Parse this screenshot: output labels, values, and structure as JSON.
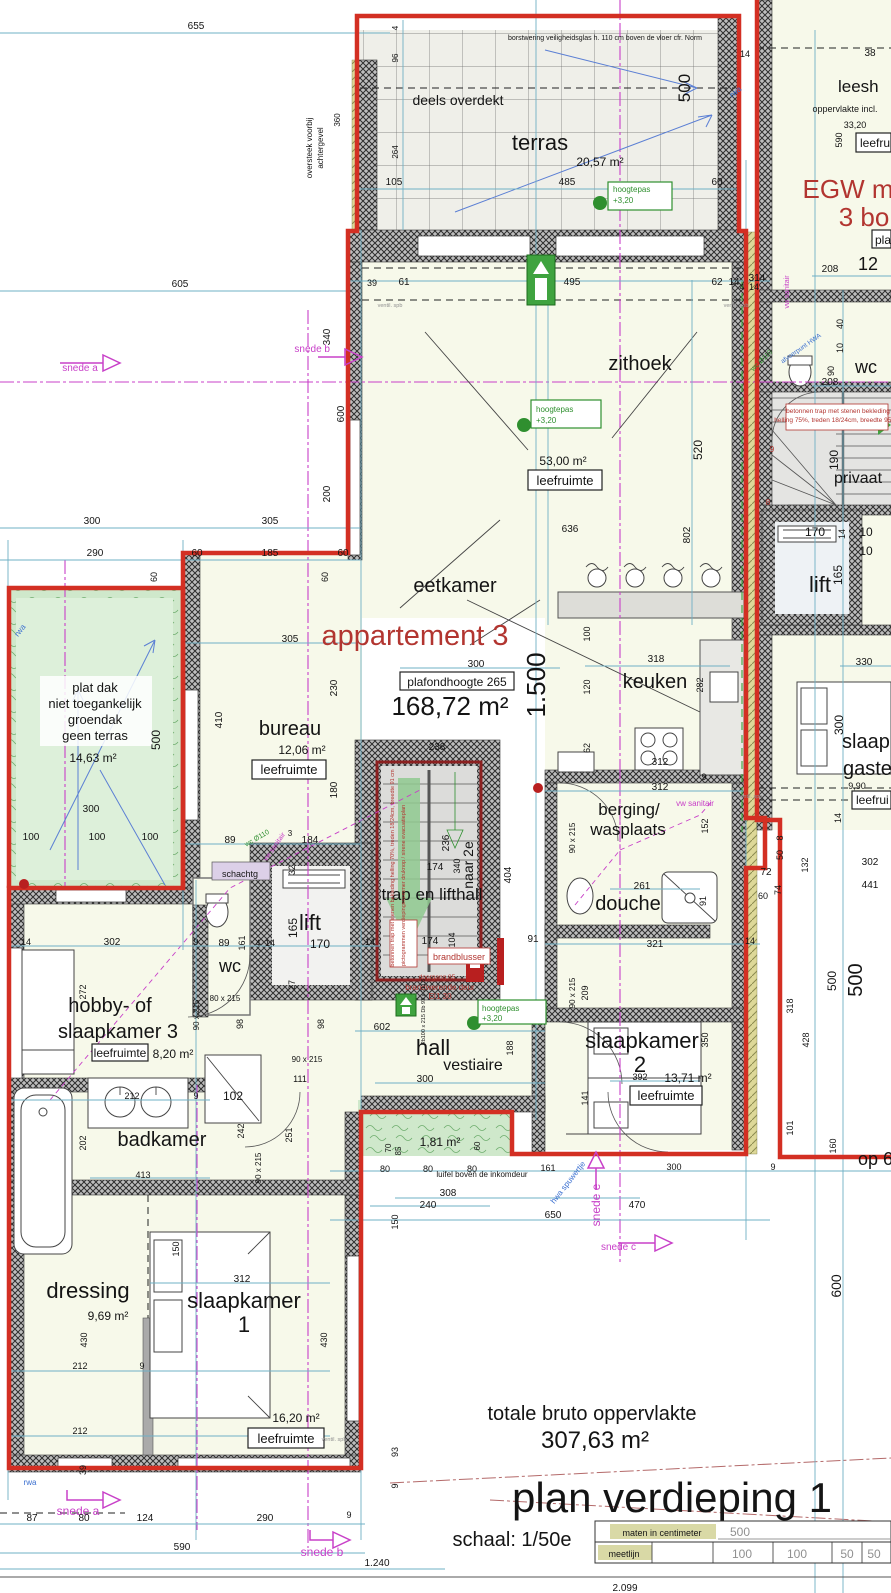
{
  "r": {
    "terras": "terras",
    "terras_a": "20,57 m²",
    "deels": "deels overdekt",
    "zithoek": "zithoek",
    "zithoek_a": "53,00 m²",
    "eetkamer": "eetkamer",
    "keuken": "keuken",
    "bureau": "bureau",
    "bureau_a": "12,06 m²",
    "traphall": "trap en lifthall",
    "naar2e": "naar 2e",
    "berging1": "berging/",
    "berging2": "wasplaats",
    "douche": "douche",
    "sk2": "slaapkamer",
    "sk2n": "2",
    "sk2_a": "13,71 m²",
    "hobby1": "hobby- of",
    "hobby2": "slaapkamer 3",
    "hobby_a": "8,20 m²",
    "badkamer": "badkamer",
    "wc": "wc",
    "lift": "lift",
    "hall": "hall",
    "vestiaire": "vestiaire",
    "dressing": "dressing",
    "dressing_a": "9,69 m²",
    "sk1": "slaapkamer",
    "sk1n": "1",
    "sk1_a": "16,20 m²",
    "privaat": "privaat",
    "schacht": "schachtg",
    "leeshoek": "leesh",
    "opp1": "oppervlakte incl.",
    "opp2": "33,20",
    "leefru": "leefru",
    "gast1": "slaapka",
    "gast2": "gaste",
    "gast_a": "9,90",
    "leefrui": "leefrui",
    "niche_a": "1,81 m²",
    "leef": "leefruimte"
  },
  "n": {
    "borst": "borstwering veiligheidsglas h. 110 cm boven de vloer cfr. Norm",
    "oversteek1": "oversteek voorbij",
    "oversteek2": "achtergevel",
    "pd1": "plat dak",
    "pd2": "niet toegankelijk",
    "pd3": "groendak",
    "pd4": "geen terras",
    "pd_a": "14,63 m²",
    "app": "appartement 3",
    "app_a": "168,72 m²",
    "plafond": "plafondhoogte 265",
    "level": "1.500",
    "hp": "hoogtepas",
    "hp_v": "+3,20",
    "egw1": "EGW m",
    "egw2": "3 bo",
    "egw3": "pla",
    "egw4": "12",
    "luifel": "luifel boven de inkomdeur",
    "trap1": "betonnen trap met stenen bekleding",
    "trap2": "helling 75%, treden 18/24cm, breedte 95 cm",
    "trapc": "betonnen trap met stenen bekleding  helling 70%, treden 18/24cm, breedte 91 cm",
    "picto": "pictogrammen verdiepingsnummer druknop / sirene evacuatieplan",
    "blus": "brandblusser",
    "deur1": "brandwerende deur",
    "deur2": "EI1 30",
    "doorg": "doorgang 85",
    "deurspec": "Rb100 x 215  Db 93 x 211,5",
    "op6": "op 6",
    "total1": "totale bruto oppervlakte",
    "total2": "307,63 m²",
    "plan": "plan  verdieping 1",
    "schaal": "schaal: 1/50e"
  },
  "u": {
    "vw": "vw sanitair",
    "wc110": "wc Ø110",
    "rwa": "rwa",
    "hwa": "hwa",
    "hwasp": "hwa spuwertje",
    "afvoer": "afvoerpunt HWA",
    "ventil": "ventil. spb"
  },
  "s": {
    "a": "snede a",
    "b": "snede b",
    "c": "snede c",
    "e": "snede e"
  },
  "lg": {
    "maten": "maten in centimeter",
    "meet": "meetlijn",
    "v500": "500",
    "v100a": "100",
    "v100b": "100",
    "v50a": "50",
    "v50b": "50"
  },
  "d": {
    "d3": "3",
    "d4": "4",
    "d8": "8",
    "d9": "9",
    "d10": "10",
    "d14": "14",
    "d27": "27",
    "d32": "32",
    "d38": "38",
    "d39": "39",
    "d40": "40",
    "d50": "50",
    "d60": "60",
    "d61": "61",
    "d62": "62",
    "d70": "70",
    "d72": "72",
    "d74": "74",
    "d80": "80",
    "d85": "85",
    "d87": "87",
    "d89": "89",
    "d90": "90",
    "d91": "91",
    "d93": "93",
    "d96": "96",
    "d98": "98",
    "d100": "100",
    "d101": "101",
    "d102": "102",
    "d104": "104",
    "d105": "105",
    "d111": "111",
    "d120": "120",
    "d124": "124",
    "d132": "132",
    "d141": "141",
    "d150": "150",
    "d152": "152",
    "d160": "160",
    "d161": "161",
    "d165": "165",
    "d170": "170",
    "d174": "174",
    "d180": "180",
    "d184": "184",
    "d185": "185",
    "d188": "188",
    "d190": "190",
    "d200": "200",
    "d202": "202",
    "d208": "208",
    "d209": "209",
    "d212": "212",
    "d230": "230",
    "d236": "236",
    "d238": "238",
    "d240": "240",
    "d242": "242",
    "d251": "251",
    "d261": "261",
    "d264": "264",
    "d272": "272",
    "d282": "282",
    "d290": "290",
    "d300": "300",
    "d302": "302",
    "d305": "305",
    "d308": "308",
    "d312": "312",
    "d314": "314",
    "d318": "318",
    "d321": "321",
    "d330": "330",
    "d340": "340",
    "d350": "350",
    "d360": "360",
    "d392": "392",
    "d404": "404",
    "d410": "410",
    "d413": "413",
    "d428": "428",
    "d430": "430",
    "d441": "441",
    "d470": "470",
    "d485": "485",
    "d495": "495",
    "d500": "500",
    "d520": "520",
    "d590": "590",
    "d600": "600",
    "d602": "602",
    "d605": "605",
    "d636": "636",
    "d650": "650",
    "d655": "655",
    "d802": "802",
    "d1240": "1.240",
    "d2099": "2.099",
    "dw80": "80 x 215",
    "dw90": "90 x 215"
  }
}
